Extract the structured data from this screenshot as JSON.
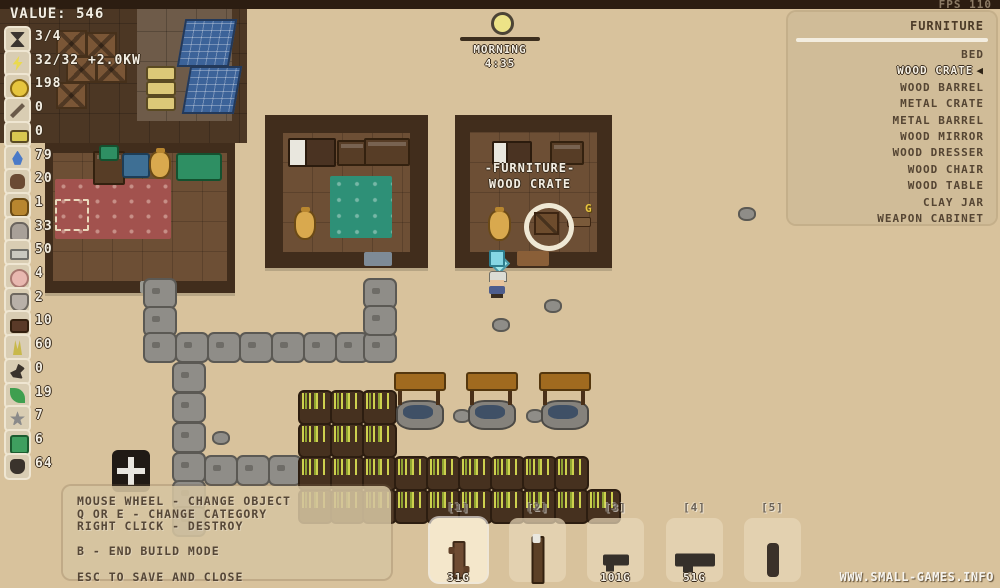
{
  "hud": {
    "value_text": "VALUE: 546",
    "fps": "FPS 110",
    "time": {
      "period": "MORNING",
      "clock": "4:35"
    },
    "resources": [
      {
        "icon": "hourglass-icon",
        "value": "3/4"
      },
      {
        "icon": "energy-icon",
        "value": "32/32 +2.0KW"
      },
      {
        "icon": "coin-icon",
        "value": "198"
      },
      {
        "icon": "pickaxe-icon",
        "value": "0"
      },
      {
        "icon": "battery-icon",
        "value": "0"
      },
      {
        "icon": "water-icon",
        "value": "79"
      },
      {
        "icon": "dirt-icon",
        "value": "20"
      },
      {
        "icon": "ore-icon",
        "value": "1"
      },
      {
        "icon": "stone-icon",
        "value": "33"
      },
      {
        "icon": "metal-bar-icon",
        "value": "50"
      },
      {
        "icon": "egg-icon",
        "value": "4"
      },
      {
        "icon": "pot-icon",
        "value": "2"
      },
      {
        "icon": "bed-icon",
        "value": "10"
      },
      {
        "icon": "wheat-icon",
        "value": "60"
      },
      {
        "icon": "bird-icon",
        "value": "0"
      },
      {
        "icon": "leaf-icon",
        "value": "19"
      },
      {
        "icon": "flower-icon",
        "value": "7"
      },
      {
        "icon": "seed-box-icon",
        "value": "6"
      },
      {
        "icon": "seed-bag-icon",
        "value": "64"
      }
    ]
  },
  "build_menu": {
    "title": "FURNITURE",
    "selector_glyph": "◀",
    "items": [
      {
        "label": "BED",
        "selected": false
      },
      {
        "label": "WOOD CRATE",
        "selected": true
      },
      {
        "label": "WOOD BARREL",
        "selected": false
      },
      {
        "label": "METAL CRATE",
        "selected": false
      },
      {
        "label": "METAL BARREL",
        "selected": false
      },
      {
        "label": "WOOD MIRROR",
        "selected": false
      },
      {
        "label": "WOOD DRESSER",
        "selected": false
      },
      {
        "label": "WOOD CHAIR",
        "selected": false
      },
      {
        "label": "WOOD TABLE",
        "selected": false
      },
      {
        "label": "CLAY JAR",
        "selected": false
      },
      {
        "label": "WEAPON CABINET",
        "selected": false
      }
    ]
  },
  "placement_label": {
    "line1": "-FURNITURE-",
    "line2": "WOOD CRATE",
    "coin_glyph": "G"
  },
  "help": {
    "lines": [
      "MOUSE WHEEL - CHANGE OBJECT",
      "Q OR E - CHANGE CATEGORY",
      "RIGHT CLICK - DESTROY",
      "",
      "B - END BUILD MODE",
      "",
      "ESC TO SAVE AND CLOSE"
    ]
  },
  "hotbar": {
    "slots": [
      {
        "key": "[1]",
        "item": "handle-tool",
        "price": "31G",
        "selected": true
      },
      {
        "key": "[2]",
        "item": "torch",
        "price": "",
        "selected": false
      },
      {
        "key": "[3]",
        "item": "pistol",
        "price": "101G",
        "selected": false
      },
      {
        "key": "[4]",
        "item": "rifle",
        "price": "51G",
        "selected": false
      },
      {
        "key": "[5]",
        "item": "club",
        "price": "",
        "selected": false
      }
    ]
  },
  "watermark": "WWW.SMALL-GAMES.INFO",
  "world": {
    "stones": [
      [
        143,
        278
      ],
      [
        143,
        306
      ],
      [
        143,
        332
      ],
      [
        175,
        332
      ],
      [
        207,
        332
      ],
      [
        239,
        332
      ],
      [
        271,
        332
      ],
      [
        303,
        332
      ],
      [
        335,
        332
      ],
      [
        363,
        332
      ],
      [
        363,
        278
      ],
      [
        363,
        305
      ],
      [
        172,
        362
      ],
      [
        172,
        392
      ],
      [
        172,
        422
      ],
      [
        172,
        452
      ],
      [
        172,
        480
      ],
      [
        172,
        506
      ],
      [
        204,
        455
      ],
      [
        236,
        455
      ],
      [
        268,
        455
      ]
    ],
    "crops": [
      [
        298,
        390
      ],
      [
        330,
        390
      ],
      [
        362,
        390
      ],
      [
        298,
        423
      ],
      [
        330,
        423
      ],
      [
        362,
        423
      ],
      [
        298,
        456
      ],
      [
        330,
        456
      ],
      [
        362,
        456
      ],
      [
        394,
        456
      ],
      [
        426,
        456
      ],
      [
        458,
        456
      ],
      [
        490,
        456
      ],
      [
        522,
        456
      ],
      [
        554,
        456
      ],
      [
        298,
        489
      ],
      [
        330,
        489
      ],
      [
        362,
        489
      ],
      [
        394,
        489
      ],
      [
        426,
        489
      ],
      [
        458,
        489
      ],
      [
        490,
        489
      ],
      [
        522,
        489
      ],
      [
        554,
        489
      ],
      [
        586,
        489
      ]
    ],
    "wells": [
      [
        396,
        372
      ],
      [
        468,
        372
      ],
      [
        541,
        372
      ]
    ],
    "pebbles": [
      [
        453,
        409
      ],
      [
        526,
        409
      ],
      [
        212,
        431
      ],
      [
        544,
        299
      ],
      [
        738,
        207
      ],
      [
        492,
        318
      ]
    ],
    "crates": [
      [
        56,
        30
      ],
      [
        86,
        32
      ],
      [
        66,
        56
      ],
      [
        96,
        56
      ],
      [
        56,
        82
      ]
    ]
  }
}
